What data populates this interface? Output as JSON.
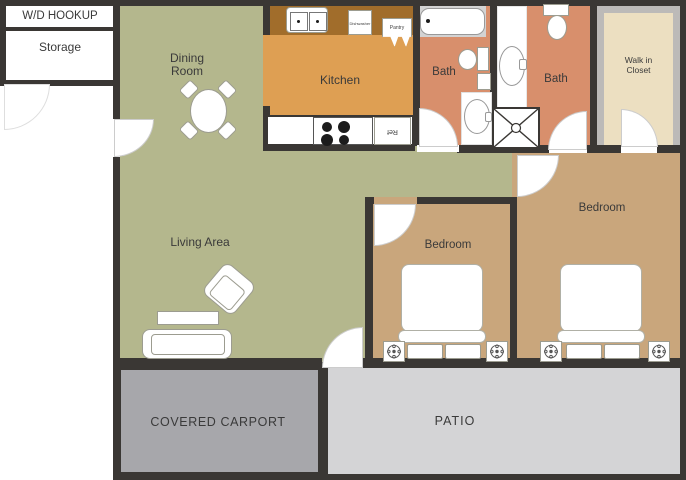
{
  "rooms": {
    "wd_hookup": "W/D HOOKUP",
    "storage": "Storage",
    "dining_room": "Dining Room",
    "kitchen": "Kitchen",
    "bath_1": "Bath",
    "bath_2": "Bath",
    "walk_in_closet": "Walk in Closet",
    "living_area": "Living Area",
    "bedroom_1": "Bedroom",
    "bedroom_2": "Bedroom",
    "covered_carport": "COVERED CARPORT",
    "patio": "PATIO"
  },
  "kitchen_fixtures": {
    "dishwasher": "Dishwasher",
    "pantry": "Pantry",
    "refrigerator": "Ref"
  },
  "colors": {
    "wall": "#3a3734",
    "living_green": "#b4b78d",
    "kitchen_orange": "#de9f53",
    "counter_brown": "#a16d2b",
    "bath_salmon": "#d88f6c",
    "closet_cream": "#ecdfc1",
    "closet_frame": "#bcbab8",
    "bedroom_tan": "#c9a67c",
    "carport_gray": "#a7a7ab",
    "patio_gray": "#d4d4d6",
    "tub_gray": "#d3d3d3",
    "wd_panel": "#f2f2f1",
    "storage_gray": "#97979b",
    "label": "#3a3a3a",
    "outline": "#9c9c90"
  }
}
